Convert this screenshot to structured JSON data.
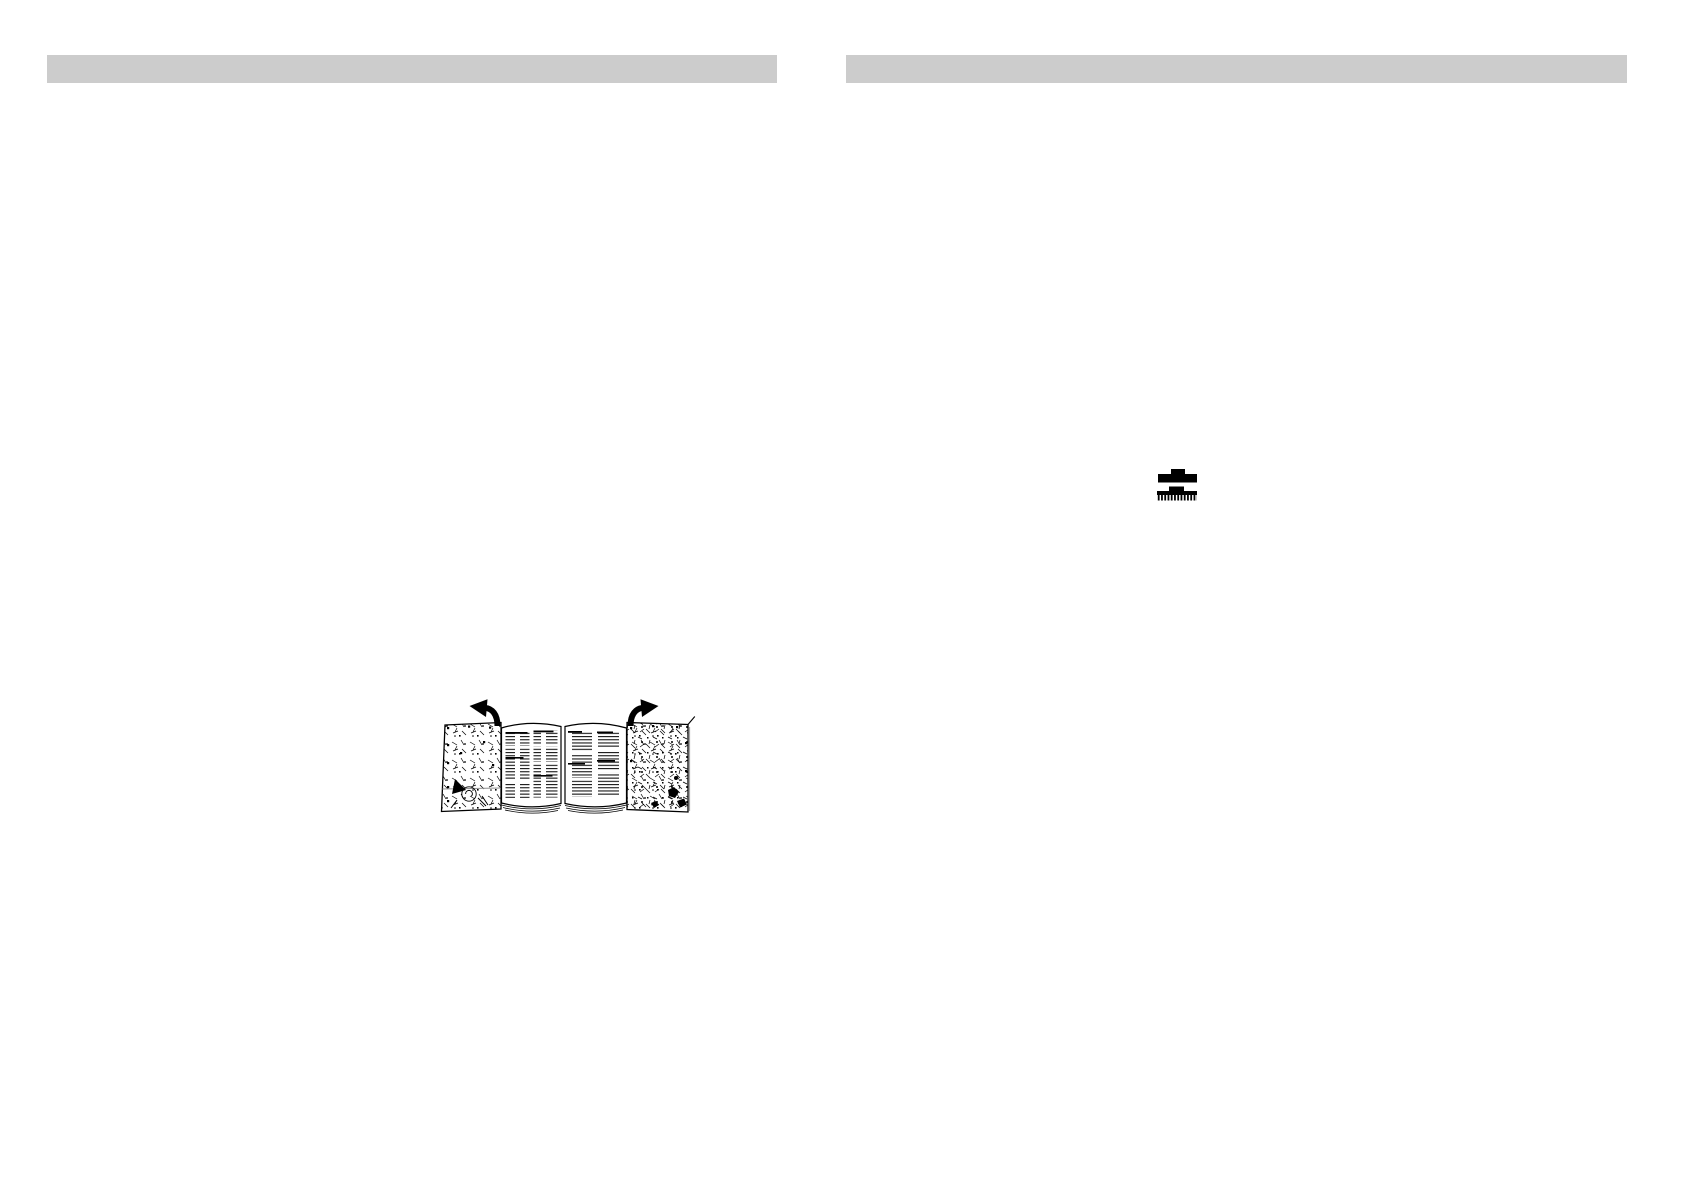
{
  "page": {
    "background": "#ffffff",
    "description": "Scanned instruction manual spread, two blank pages with gray header bars"
  },
  "header": {
    "left_bar": {
      "color": "#cccccc"
    },
    "right_bar": {
      "color": "#cccccc"
    }
  },
  "icons": {
    "brush": {
      "name": "cleaning-brush-icon",
      "color": "#000000",
      "description": "Small black brush shown twice: solid back view above, bristle view below"
    }
  },
  "illustration": {
    "name": "fold-out-booklet",
    "description": "Open fold-out leaflet: left and right outer panels filled with small drawings, two center pages with columns of tiny text, curved black arrows showing the panels unfolding outward",
    "ink_color": "#000000",
    "arrow_color": "#000000",
    "panel_fill": "#ffffff",
    "accent_line_color": "#8f8f8f"
  }
}
